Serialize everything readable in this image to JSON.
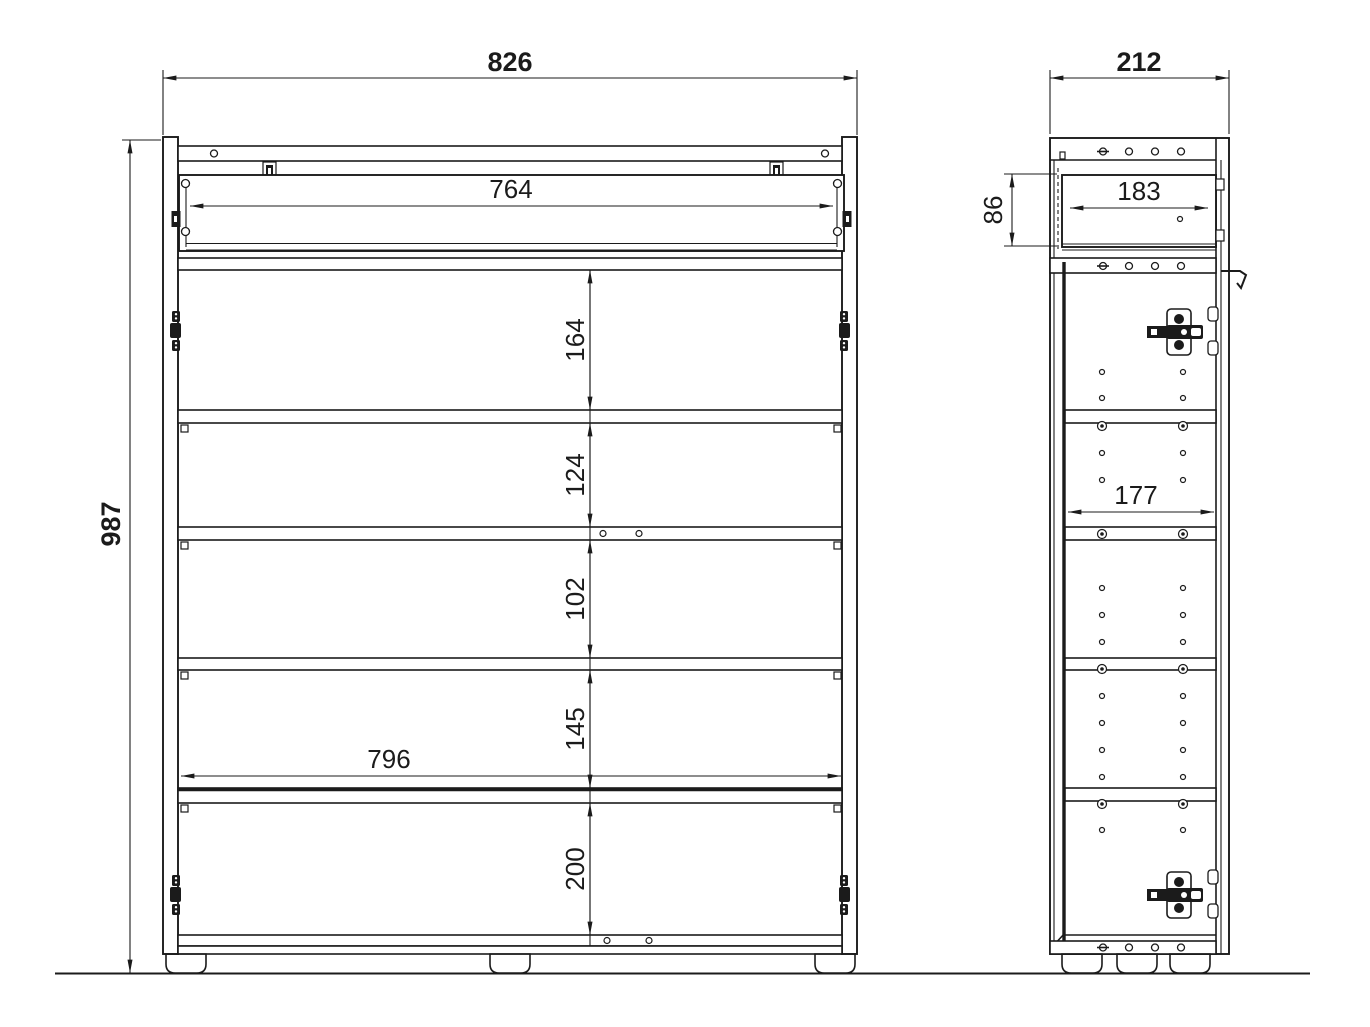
{
  "drawing": {
    "type": "furniture-technical-drawing",
    "background_color": "#ffffff",
    "line_color": "#1b1b1b",
    "views": {
      "front": "front-view",
      "side": "side-view"
    },
    "dimensions": {
      "overall_width": "826",
      "overall_height": "987",
      "overall_depth": "212",
      "drawer_inner_width": "764",
      "drawer_inner_depth": "183",
      "drawer_inner_height": "86",
      "compartment_1_height": "164",
      "compartment_2_height": "124",
      "compartment_3_height": "102",
      "compartment_4_height": "145",
      "compartment_5_height": "200",
      "interior_width": "796",
      "interior_depth": "177"
    }
  }
}
